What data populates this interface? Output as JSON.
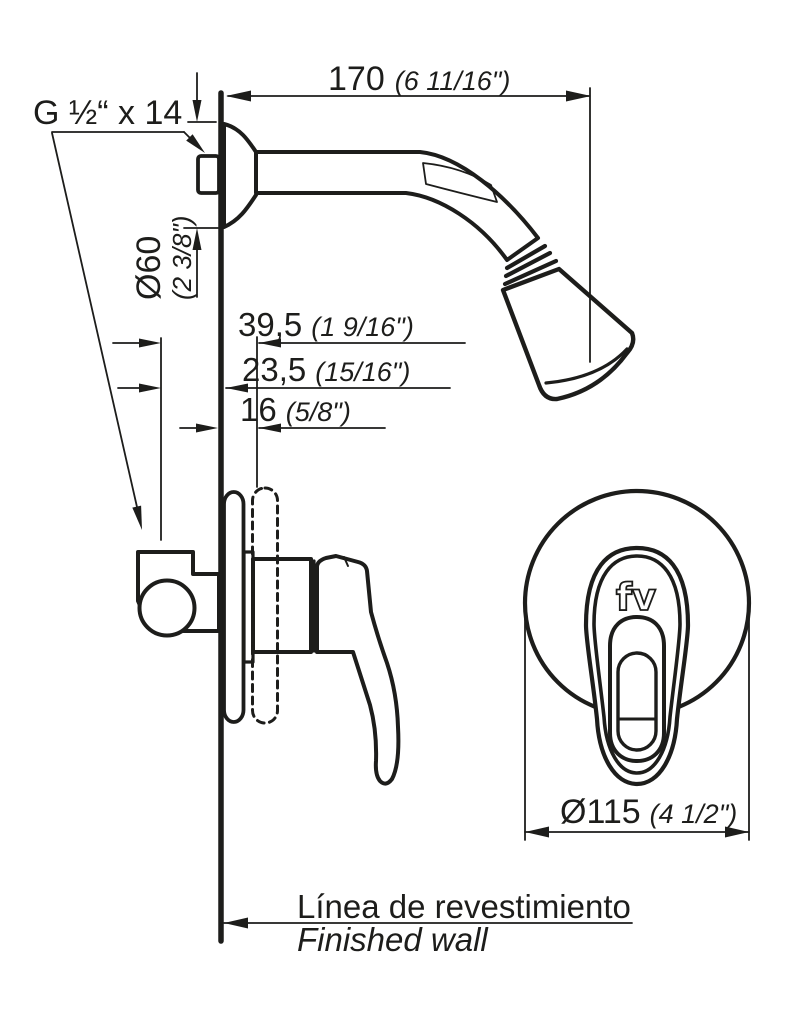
{
  "drawing": {
    "kind": "shower-mixer-installation-diagram",
    "labels": {
      "thread": "G ½“ x 14",
      "wall_line_es": "Línea de revestimiento",
      "wall_line_en": "Finished wall",
      "logo": "fv"
    },
    "dimensions": {
      "arm_projection": {
        "mm": "170",
        "inch": "(6 11/16\")"
      },
      "flange_diameter": {
        "mm": "Ø60",
        "inch": "(2 3/8\")"
      },
      "depth_max": {
        "mm": "39,5",
        "inch": "(1 9/16\")"
      },
      "depth_mid": {
        "mm": "23,5",
        "inch": "(15/16\")"
      },
      "depth_min": {
        "mm": "16",
        "inch": "(5/8\")"
      },
      "plate_diameter": {
        "mm": "Ø115",
        "inch": "(4 1/2\")"
      }
    },
    "colors": {
      "ink": "#1d1d1b",
      "background": "#ffffff"
    }
  }
}
